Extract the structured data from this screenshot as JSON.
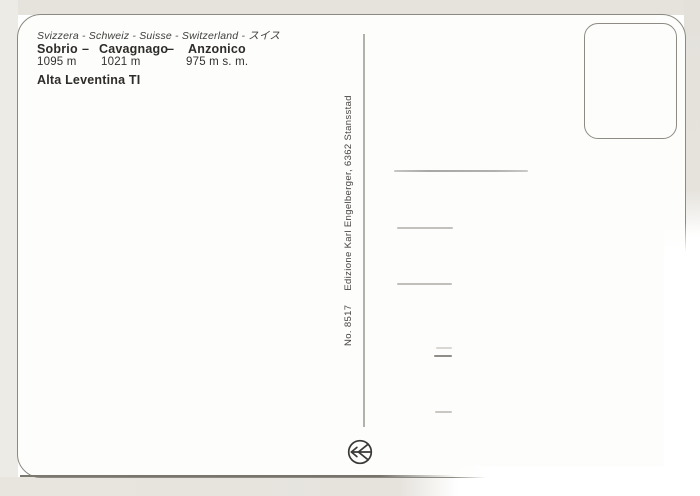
{
  "scan": {
    "type": "postcard-back",
    "colors": {
      "background": "#e6e3dd",
      "card": "#fdfdfb",
      "edge_line": "#8b8981",
      "text": "#2e2c29",
      "logo": "#3b3936"
    }
  },
  "header": {
    "countries_line": "Svizzera - Schweiz - Suisse - Switzerland - スイス",
    "separator": "–",
    "places": [
      {
        "name": "Sobrio",
        "altitude": "1095 m"
      },
      {
        "name": "Cavagnago",
        "altitude": "1021 m"
      },
      {
        "name": "Anzonico",
        "altitude": "975 m s. m."
      }
    ],
    "region_line": "Alta Leventina TI"
  },
  "publisher": {
    "number": "No. 8517",
    "edition": "Edizione Karl Engelberger, 6362 Stansstad"
  }
}
